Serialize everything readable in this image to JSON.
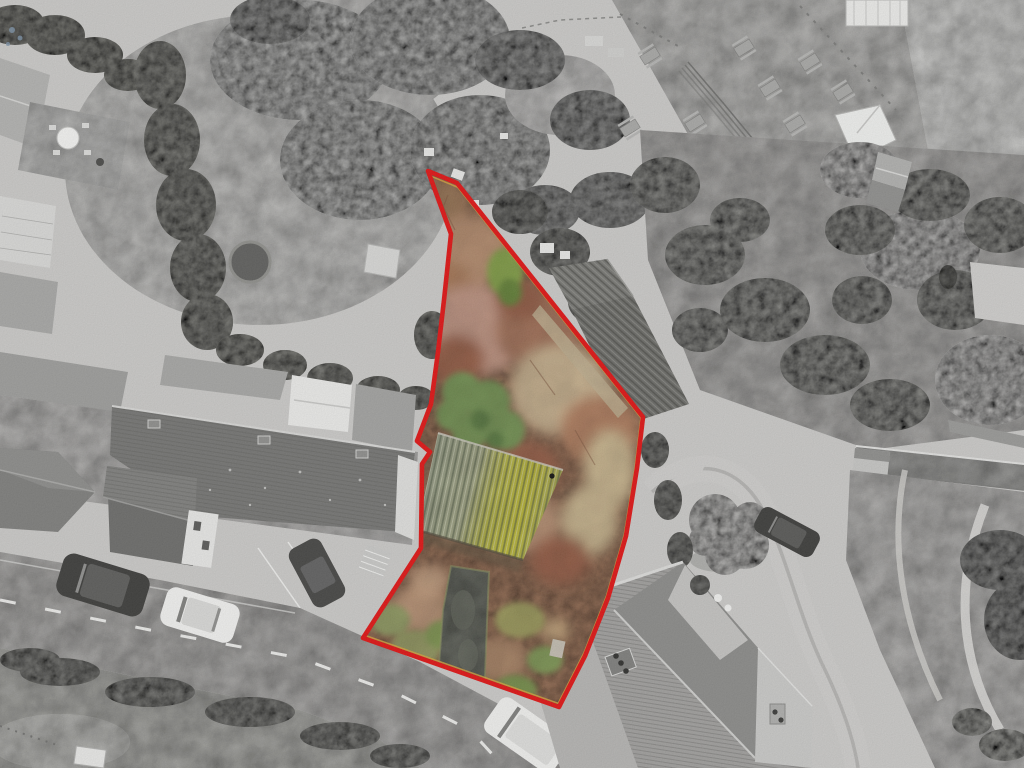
{
  "image": {
    "alt": "Aerial drone photograph of a roughly triangular development plot outlined in red. The plot interior is in colour (rust bracken, green bushes, a moss-covered corrugated shed and a grey driveway) while the surroundings are desaturated: terraced house roofs and a road with parked cars lower left, a pub beer garden with picnic tables and a play structure top right, winter woodland and a walled lane on the right.",
    "width": 1024,
    "height": 768
  },
  "boundary": {
    "points": "428,171 457,183 643,417 637,468 626,536 608,598 585,656 559,707 363,638 421,548 422,464 430,452 417,441 431,404 438,352 444,300 451,234",
    "color": "#e01212",
    "stroke_width": 4.6,
    "inner_line": {
      "color": "#d9a33c",
      "stroke_width": 1.6,
      "transform": "translate(7.6,7.0) scale(0.985)"
    }
  },
  "palette": {
    "ground": "#cbcac8",
    "lawn": "#d2d1cf",
    "hedge": "#8f8f89",
    "woodland": "#b7b6b4",
    "roof_dark": "#757573",
    "roof_mid": "#9d9d9b",
    "roof_light": "#c9c9c7",
    "road": "#b9b8b6",
    "road_marking": "#f0f0ee",
    "lane": "#cecdcb",
    "wall": "#a5a5a3",
    "bracken": "#bc8a6a",
    "bracken_dark": "#a2654c",
    "bracken_pink": "#cfa08c",
    "dry_grass": "#d9c49c",
    "bush_green": "#7c9c58",
    "moss_yellow": "#cfcb3a",
    "shed_green_gray": "#9aa28e",
    "driveway": "#7b7f74",
    "car_dark": "#3c3c3a",
    "car_white": "#f2f2f0"
  }
}
